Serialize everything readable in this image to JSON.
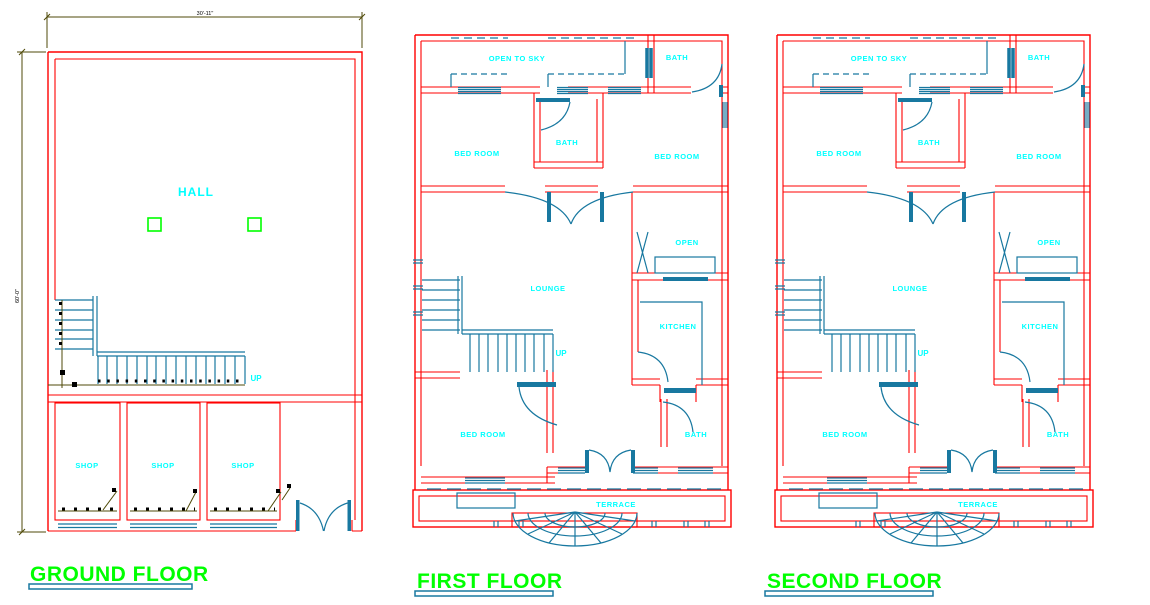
{
  "drawing_type": "architectural floor plans",
  "colors": {
    "background": "#ffffff",
    "wall": "#ff0000",
    "fixture": "#1878a0",
    "room_label": "#00ffff",
    "title": "#00ff00",
    "title_underline": "#1878a0",
    "dimension_line": "#4f4a08",
    "dimension_text": "#000000",
    "column": "#00ff00"
  },
  "plans": {
    "ground": {
      "title": "GROUND FLOOR",
      "rooms": {
        "hall": "HALL",
        "shop1": "SHOP",
        "shop2": "SHOP",
        "shop3": "SHOP"
      },
      "stair_label": "UP",
      "dimensions": {
        "width": "30'-11\"",
        "height": "60'-0\""
      }
    },
    "first": {
      "title": "FIRST FLOOR",
      "rooms": {
        "open_to_sky": "OPEN TO SKY",
        "bath_top": "BATH",
        "bed_left": "BED ROOM",
        "bath_mid": "BATH",
        "bed_right": "BED ROOM",
        "lounge": "LOUNGE",
        "open": "OPEN",
        "kitchen": "KITCHEN",
        "bed_bottom": "BED ROOM",
        "bath_bottom": "BATH",
        "terrace": "TERRACE"
      },
      "stair_label": "UP"
    },
    "second": {
      "title": "SECOND FLOOR",
      "rooms": {
        "open_to_sky": "OPEN TO SKY",
        "bath_top": "BATH",
        "bed_left": "BED ROOM",
        "bath_mid": "BATH",
        "bed_right": "BED ROOM",
        "lounge": "LOUNGE",
        "open": "OPEN",
        "kitchen": "KITCHEN",
        "bed_bottom": "BED ROOM",
        "bath_bottom": "BATH",
        "terrace": "TERRACE"
      },
      "stair_label": "UP"
    }
  }
}
